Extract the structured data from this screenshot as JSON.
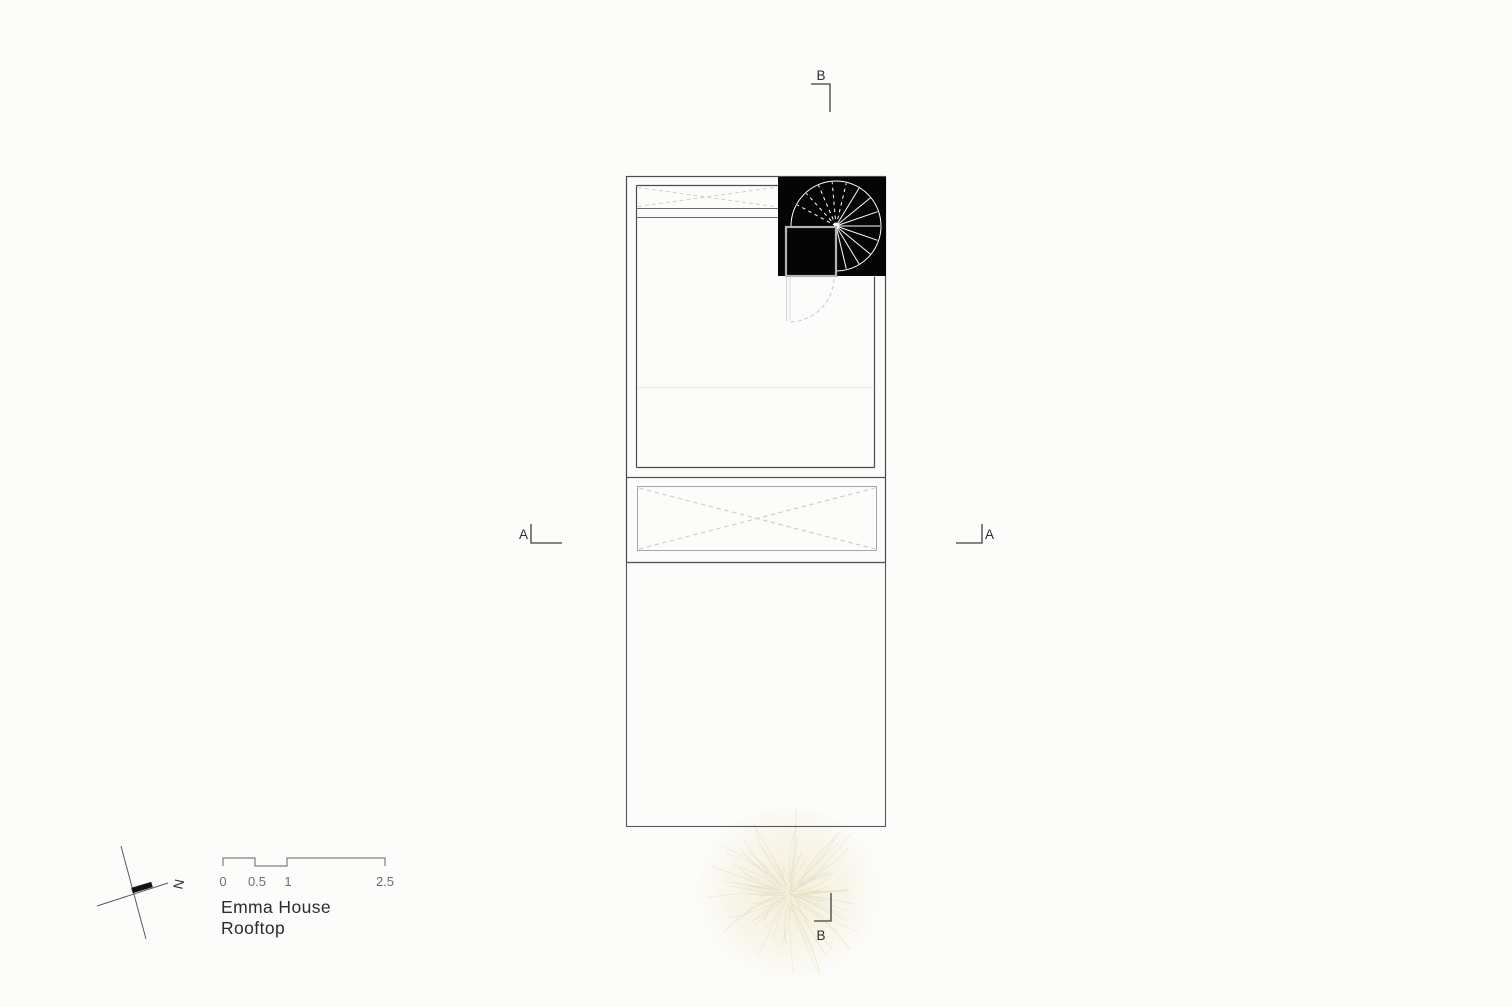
{
  "title": {
    "line1": "Emma House",
    "line2": "Rooftop"
  },
  "north": {
    "label": "N"
  },
  "scale_bar": {
    "labels": [
      "0",
      "0.5",
      "1",
      "2.5"
    ]
  },
  "section_markers": {
    "b_top": "B",
    "b_bottom": "B",
    "a_left": "A",
    "a_right": "A"
  },
  "colors": {
    "wall_line": "#4c4c4c",
    "thin_line": "#8a8a8a",
    "dashed_light": "#c9c9c9",
    "faint_line": "#e9e9e7",
    "stair_box": "#050505",
    "stair_stroke": "#ffffff",
    "tree_tint": "#eee4b9"
  }
}
